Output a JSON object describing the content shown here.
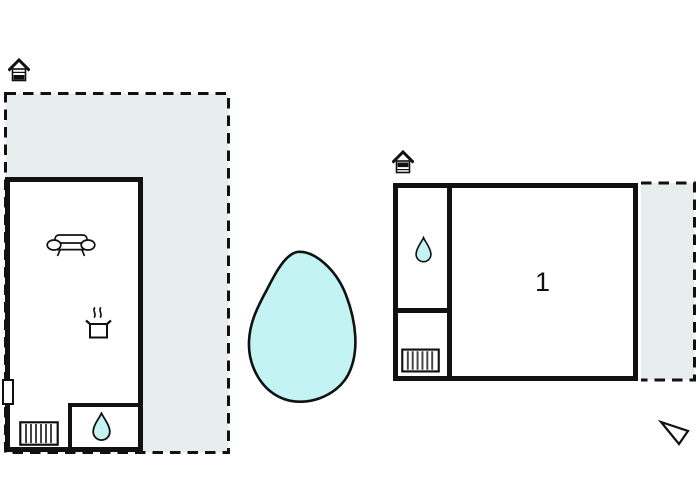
{
  "floorplan": {
    "room_label": "1",
    "colors": {
      "wall": "#111111",
      "terrace_fill": "#e8edee",
      "water_fill": "#c3f3f2",
      "background": "#ffffff"
    },
    "icons": {
      "house": "gable-roof-house-entrance-marker",
      "sofa": "sofa-front-view",
      "cooking_pot": "pot-with-steam-lines",
      "radiator": "striped-rectangle-grill",
      "water_drop": "teardrop",
      "direction_arrow": "open-triangle-pointer"
    }
  }
}
